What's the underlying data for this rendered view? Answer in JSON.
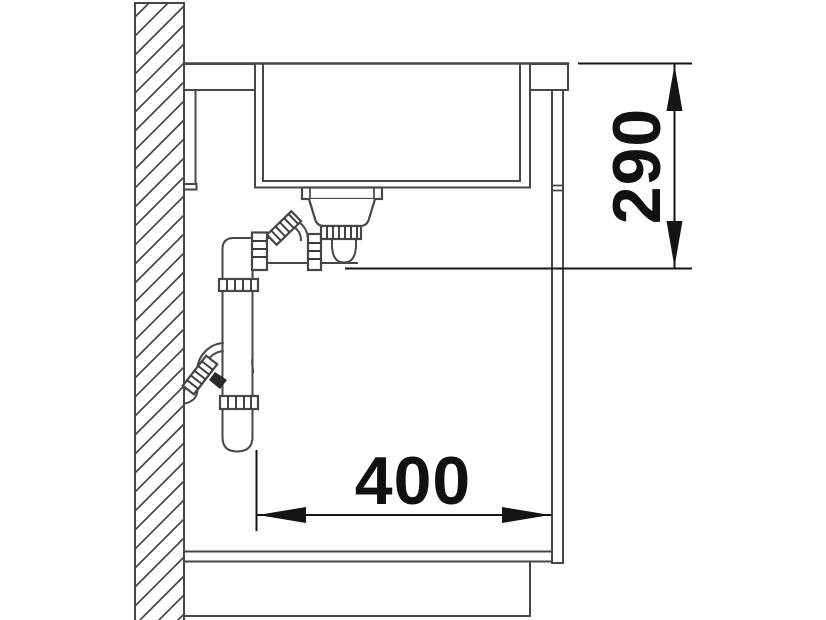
{
  "diagram": {
    "kind": "sink-installation-cross-section",
    "dimension_vertical": {
      "value": "290",
      "orientation": "vertical"
    },
    "dimension_horizontal": {
      "value": "400",
      "orientation": "horizontal"
    },
    "colors": {
      "line": "#474747",
      "dimension": "#141414",
      "background": "#ffffff"
    }
  }
}
